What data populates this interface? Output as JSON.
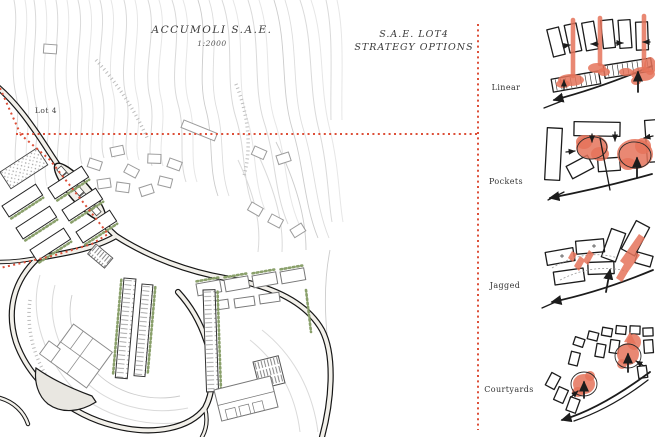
{
  "colors": {
    "accent_red": "#dd4f38",
    "blob_salmon": "#e5735b",
    "vegetation_green": "#8aa06b",
    "road_ink": "#161616",
    "contour_gray": "#dadada"
  },
  "map": {
    "title": "ACCUMOLI S.A.E.",
    "scale": "1:2000",
    "lot_label": "Lot 4"
  },
  "options_panel": {
    "title_line1": "S.A.E. LOT4",
    "title_line2": "STRATEGY OPTIONS",
    "options": [
      {
        "label": "Linear"
      },
      {
        "label": "Pockets"
      },
      {
        "label": "Jagged"
      },
      {
        "label": "Courtyards"
      }
    ]
  }
}
